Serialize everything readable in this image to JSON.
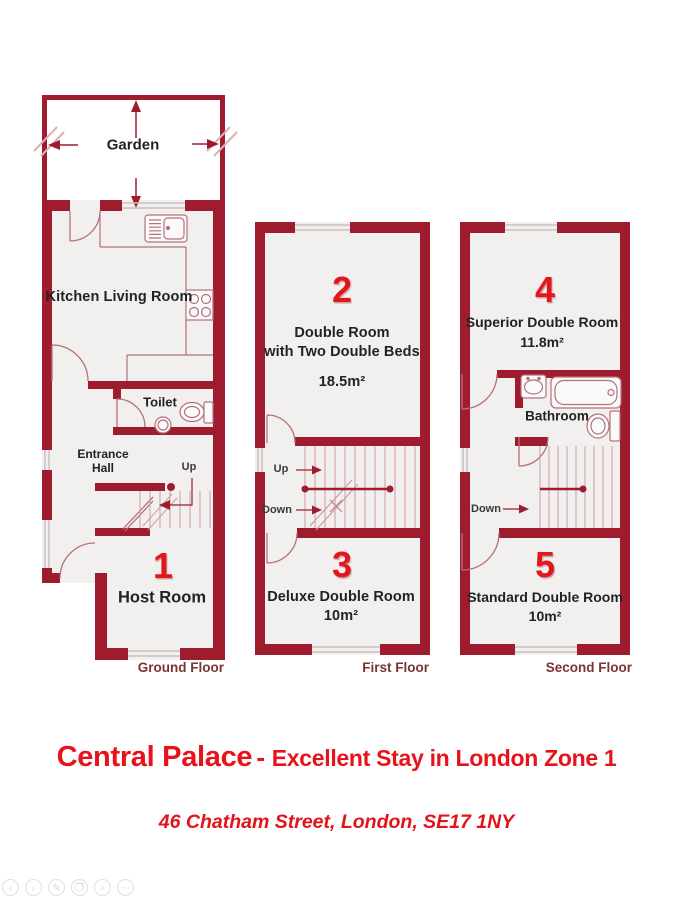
{
  "floors": {
    "ground": {
      "garden_label": "Garden",
      "kitchen_label": "Kitchen Living Room",
      "toilet_label": "Toilet",
      "entrance_line1": "Entrance",
      "entrance_line2": "Hall",
      "stairs_up": "Up",
      "room1_number": "1",
      "room1_name": "Host Room",
      "floor_label": "Ground Floor"
    },
    "first": {
      "room2_number": "2",
      "room2_name_line1": "Double Room",
      "room2_name_line2": "with Two Double Beds",
      "room2_area": "18.5m²",
      "stairs_up": "Up",
      "stairs_down": "Down",
      "room3_number": "3",
      "room3_name": "Deluxe Double Room",
      "room3_area": "10m²",
      "floor_label": "First Floor"
    },
    "second": {
      "room4_number": "4",
      "room4_name": "Superior Double Room",
      "room4_area": "11.8m²",
      "bathroom_label": "Bathroom",
      "stairs_down": "Down",
      "room5_number": "5",
      "room5_name": "Standard Double Room",
      "room5_area": "10m²",
      "floor_label": "Second Floor"
    }
  },
  "title": {
    "property_name": "Central Palace",
    "separator": "-",
    "tagline": "Excellent Stay in London Zone 1"
  },
  "address": "46 Chatham Street, London, SE17 1NY",
  "colors": {
    "wall_red": "#9f1b2e",
    "fixture_red": "#b4707c",
    "step_red": "#cf9aa4",
    "room_fill": "#f2f0ef",
    "number_red": "#e2171d",
    "title_red": "#e8131a",
    "floor_label_maroon": "#7b3333"
  },
  "toolbar": {
    "icons": [
      {
        "name": "back",
        "glyph": "‹"
      },
      {
        "name": "forward",
        "glyph": "›"
      },
      {
        "name": "edit",
        "glyph": "✎"
      },
      {
        "name": "copy",
        "glyph": "❐"
      },
      {
        "name": "zoom",
        "glyph": "⌕"
      },
      {
        "name": "more",
        "glyph": "⋯"
      }
    ]
  }
}
